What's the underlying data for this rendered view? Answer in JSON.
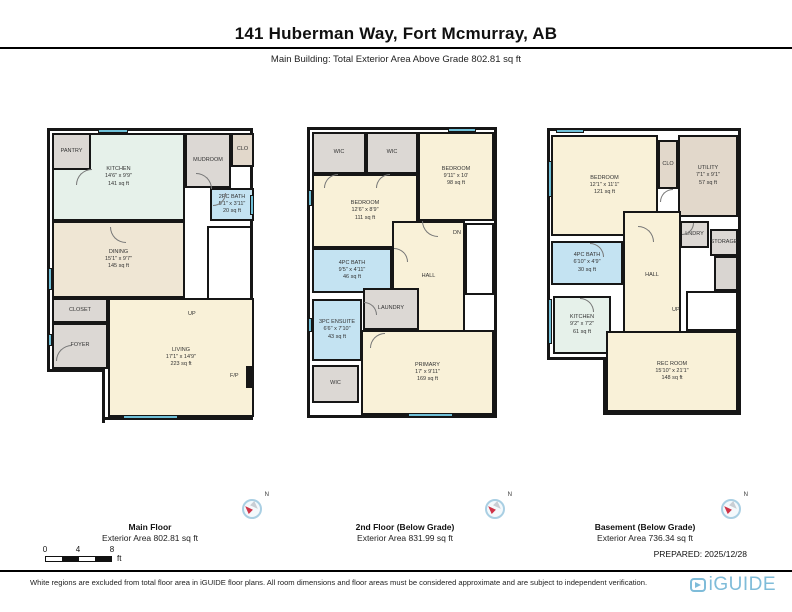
{
  "header": {
    "title": "141 Huberman Way, Fort Mcmurray, AB",
    "subtitle": "Main Building: Total Exterior Area Above Grade 802.81 sq ft"
  },
  "colors": {
    "wall": "#161616",
    "mint": "#e6f1ea",
    "cream": "#f9f1d8",
    "dining": "#efe6d4",
    "gray": "#dcd8d4",
    "tan": "#e2d8cb",
    "blue": "#c4e3f2",
    "stair": "#ffffff",
    "landing": "#d9d5d1",
    "window": "#6fc0d8",
    "compass_red": "#cf3347",
    "logo_blue": "#7fbcd9"
  },
  "compass": {
    "n_label": "N"
  },
  "scale": {
    "t0": "0",
    "t1": "4",
    "t2": "8",
    "unit": "ft"
  },
  "plans": [
    {
      "caption_line1": "Main Floor",
      "caption_line2": "Exterior Area 802.81 sq ft",
      "rooms": [
        {
          "name": "room-kitchen",
          "x": 2,
          "y": 2,
          "w": 133,
          "h": 88,
          "fill": "mint",
          "lines": [
            "KITCHEN",
            "14'6\" x 9'9\"",
            "141 sq ft"
          ]
        },
        {
          "name": "room-pantry",
          "x": 2,
          "y": 2,
          "w": 39,
          "h": 37,
          "fill": "gray",
          "lines": [
            "PANTRY"
          ]
        },
        {
          "name": "room-mudroom",
          "x": 135,
          "y": 2,
          "w": 46,
          "h": 55,
          "fill": "gray",
          "lines": [
            "MUDROOM"
          ]
        },
        {
          "name": "room-clo",
          "x": 181,
          "y": 2,
          "w": 23,
          "h": 34,
          "fill": "tan",
          "lines": [
            "CLO"
          ]
        },
        {
          "name": "room-2pc-bath",
          "x": 160,
          "y": 57,
          "w": 44,
          "h": 33,
          "fill": "blue",
          "lines": [
            "2PC BATH",
            "5'1\" x 3'11\"",
            "20 sq ft"
          ]
        },
        {
          "name": "room-dining",
          "x": 2,
          "y": 90,
          "w": 133,
          "h": 77,
          "fill": "dining",
          "lines": [
            "DINING",
            "15'1\" x 9'7\"",
            "145 sq ft"
          ]
        },
        {
          "name": "stairs-up",
          "x": 157,
          "y": 95,
          "w": 45,
          "h": 88,
          "fill": "stair",
          "treads": "h"
        },
        {
          "name": "room-closet",
          "x": 2,
          "y": 167,
          "w": 56,
          "h": 25,
          "fill": "gray",
          "lines": [
            "CLOSET"
          ]
        },
        {
          "name": "room-foyer",
          "x": 2,
          "y": 192,
          "w": 56,
          "h": 46,
          "fill": "gray",
          "lines": [
            "FOYER"
          ]
        },
        {
          "name": "room-living",
          "x": 58,
          "y": 167,
          "w": 146,
          "h": 119,
          "fill": "cream",
          "lines": [
            "LIVING",
            "17'1\" x 14'9\"",
            "223 sq ft"
          ]
        },
        {
          "name": "fireplace",
          "x": 196,
          "y": 235,
          "w": 8,
          "h": 22,
          "fill": "wall"
        },
        {
          "name": "exterior-cutout",
          "x": -3,
          "y": 238,
          "w": 58,
          "h": 54,
          "cutout": true
        }
      ],
      "labels": [
        {
          "text": "UP",
          "x": 138,
          "y": 180
        },
        {
          "text": "F/P",
          "x": 180,
          "y": 242
        }
      ],
      "windows": [
        {
          "x": 48,
          "y": -2,
          "w": 30,
          "h": 4
        },
        {
          "x": -2,
          "y": 137,
          "w": 4,
          "h": 22
        },
        {
          "x": -2,
          "y": 203,
          "w": 4,
          "h": 12
        },
        {
          "x": 73,
          "y": 284,
          "w": 55,
          "h": 4
        },
        {
          "x": 200,
          "y": 64,
          "w": 4,
          "h": 20
        }
      ],
      "doors": [
        {
          "x": 26,
          "y": 38,
          "s": 16,
          "rot": 0
        },
        {
          "x": 146,
          "y": 42,
          "s": 16,
          "rot": 90
        },
        {
          "x": 163,
          "y": 62,
          "s": 13,
          "rot": 180
        },
        {
          "x": 6,
          "y": 214,
          "s": 16,
          "rot": 0
        },
        {
          "x": 60,
          "y": 96,
          "s": 16,
          "rot": 270
        }
      ]
    },
    {
      "caption_line1": "2nd Floor (Below Grade)",
      "caption_line2": "Exterior Area 831.99 sq ft",
      "rooms": [
        {
          "name": "room-wic",
          "x": 2,
          "y": 2,
          "w": 54,
          "h": 42,
          "fill": "gray",
          "lines": [
            "WIC"
          ]
        },
        {
          "name": "room-wic",
          "x": 56,
          "y": 2,
          "w": 52,
          "h": 42,
          "fill": "gray",
          "lines": [
            "WIC"
          ]
        },
        {
          "name": "room-bedroom",
          "x": 108,
          "y": 2,
          "w": 76,
          "h": 89,
          "fill": "cream",
          "lines": [
            "BEDROOM",
            "9'11\" x 10'",
            "98 sq ft"
          ]
        },
        {
          "name": "room-bedroom",
          "x": 2,
          "y": 44,
          "w": 106,
          "h": 74,
          "fill": "cream",
          "lines": [
            "BEDROOM",
            "12'6\" x 8'9\"",
            "111 sq ft"
          ]
        },
        {
          "name": "room-4pc-bath",
          "x": 2,
          "y": 118,
          "w": 80,
          "h": 45,
          "fill": "blue",
          "lines": [
            "4PC BATH",
            "9'5\" x 4'11\"",
            "46 sq ft"
          ]
        },
        {
          "name": "room-hall",
          "x": 82,
          "y": 91,
          "w": 73,
          "h": 112,
          "fill": "cream",
          "lines": [
            "HALL"
          ]
        },
        {
          "name": "stairs-down",
          "x": 155,
          "y": 93,
          "w": 29,
          "h": 72,
          "fill": "stair",
          "treads": "h"
        },
        {
          "name": "room-laundry",
          "x": 53,
          "y": 158,
          "w": 56,
          "h": 42,
          "fill": "gray",
          "lines": [
            "LAUNDRY"
          ]
        },
        {
          "name": "room-3pc-ensuite",
          "x": 2,
          "y": 169,
          "w": 50,
          "h": 62,
          "fill": "blue",
          "lines": [
            "3PC ENSUITE",
            "6'6\" x 7'10\"",
            "43 sq ft"
          ]
        },
        {
          "name": "room-wic",
          "x": 2,
          "y": 235,
          "w": 47,
          "h": 38,
          "fill": "gray",
          "lines": [
            "WIC"
          ]
        },
        {
          "name": "room-primary",
          "x": 51,
          "y": 200,
          "w": 133,
          "h": 85,
          "fill": "cream",
          "lines": [
            "PRIMARY",
            "17' x 9'11\"",
            "169 sq ft"
          ]
        }
      ],
      "labels": [
        {
          "text": "DN",
          "x": 143,
          "y": 100
        }
      ],
      "windows": [
        {
          "x": 138,
          "y": -2,
          "w": 28,
          "h": 4
        },
        {
          "x": -2,
          "y": 60,
          "w": 4,
          "h": 16
        },
        {
          "x": -2,
          "y": 188,
          "w": 4,
          "h": 14
        },
        {
          "x": 98,
          "y": 283,
          "w": 45,
          "h": 4
        }
      ],
      "doors": [
        {
          "x": 14,
          "y": 44,
          "s": 14,
          "rot": 0
        },
        {
          "x": 66,
          "y": 44,
          "s": 14,
          "rot": 0
        },
        {
          "x": 112,
          "y": 91,
          "s": 16,
          "rot": 270
        },
        {
          "x": 84,
          "y": 118,
          "s": 14,
          "rot": 90
        },
        {
          "x": 54,
          "y": 172,
          "s": 13,
          "rot": 90
        },
        {
          "x": 60,
          "y": 203,
          "s": 15,
          "rot": 0
        }
      ]
    },
    {
      "caption_line1": "Basement (Below Grade)",
      "caption_line2": "Exterior Area 736.34 sq ft",
      "rooms": [
        {
          "name": "room-bedroom",
          "x": 1,
          "y": 4,
          "w": 107,
          "h": 101,
          "fill": "cream",
          "lines": [
            "BEDROOM",
            "12'1\" x 11'1\"",
            "121 sq ft"
          ]
        },
        {
          "name": "room-clo",
          "x": 108,
          "y": 9,
          "w": 20,
          "h": 49,
          "fill": "tan",
          "lines": [
            "CLO"
          ]
        },
        {
          "name": "room-utility",
          "x": 128,
          "y": 4,
          "w": 60,
          "h": 82,
          "fill": "tan",
          "lines": [
            "UTILITY",
            "7'1\" x 9'1\"",
            "57 sq ft"
          ]
        },
        {
          "name": "room-lndry",
          "x": 130,
          "y": 90,
          "w": 29,
          "h": 27,
          "fill": "gray",
          "lines": [
            "LNDRY"
          ]
        },
        {
          "name": "room-storage",
          "x": 160,
          "y": 98,
          "w": 28,
          "h": 27,
          "fill": "gray",
          "lines": [
            "STORAGE"
          ]
        },
        {
          "name": "room-4pc-bath",
          "x": 1,
          "y": 110,
          "w": 72,
          "h": 44,
          "fill": "blue",
          "lines": [
            "4PC BATH",
            "6'10\" x 4'9\"",
            "30 sq ft"
          ]
        },
        {
          "name": "room-hall",
          "x": 73,
          "y": 80,
          "w": 58,
          "h": 130,
          "fill": "cream",
          "lines": [
            "HALL"
          ]
        },
        {
          "name": "stair-landing",
          "x": 164,
          "y": 125,
          "w": 24,
          "h": 35,
          "fill": "landing"
        },
        {
          "name": "stairs-up",
          "x": 136,
          "y": 160,
          "w": 52,
          "h": 40,
          "fill": "stair",
          "treads": "v"
        },
        {
          "name": "room-kitchen",
          "x": 3,
          "y": 165,
          "w": 58,
          "h": 58,
          "fill": "mint",
          "lines": [
            "KITCHEN",
            "9'2\" x 7'2\"",
            "61 sq ft"
          ]
        },
        {
          "name": "room-rec-room",
          "x": 56,
          "y": 200,
          "w": 132,
          "h": 81,
          "fill": "cream",
          "lines": [
            "REC ROOM",
            "15'10\" x 21'1\"",
            "148 sq ft"
          ]
        },
        {
          "name": "exterior-cutout",
          "x": -3,
          "y": 226,
          "w": 59,
          "h": 58,
          "cutout": true
        }
      ],
      "labels": [
        {
          "text": "UP",
          "x": 122,
          "y": 176
        }
      ],
      "windows": [
        {
          "x": -2,
          "y": 30,
          "w": 4,
          "h": 36
        },
        {
          "x": -2,
          "y": 168,
          "w": 4,
          "h": 45
        },
        {
          "x": 6,
          "y": -2,
          "w": 28,
          "h": 4
        }
      ],
      "doors": [
        {
          "x": 88,
          "y": 95,
          "s": 16,
          "rot": 90
        },
        {
          "x": 40,
          "y": 112,
          "s": 14,
          "rot": 90
        },
        {
          "x": 30,
          "y": 167,
          "s": 14,
          "rot": 90
        },
        {
          "x": 132,
          "y": 92,
          "s": 12,
          "rot": 180
        },
        {
          "x": 110,
          "y": 58,
          "s": 13,
          "rot": 0
        }
      ]
    }
  ],
  "footer": {
    "prepared": "PREPARED: 2025/12/28",
    "disclaimer": "White regions are excluded from total floor area in iGUIDE floor plans. All room dimensions and floor areas must be considered approximate and are subject to independent verification.",
    "logo_text": "iGUIDE"
  }
}
